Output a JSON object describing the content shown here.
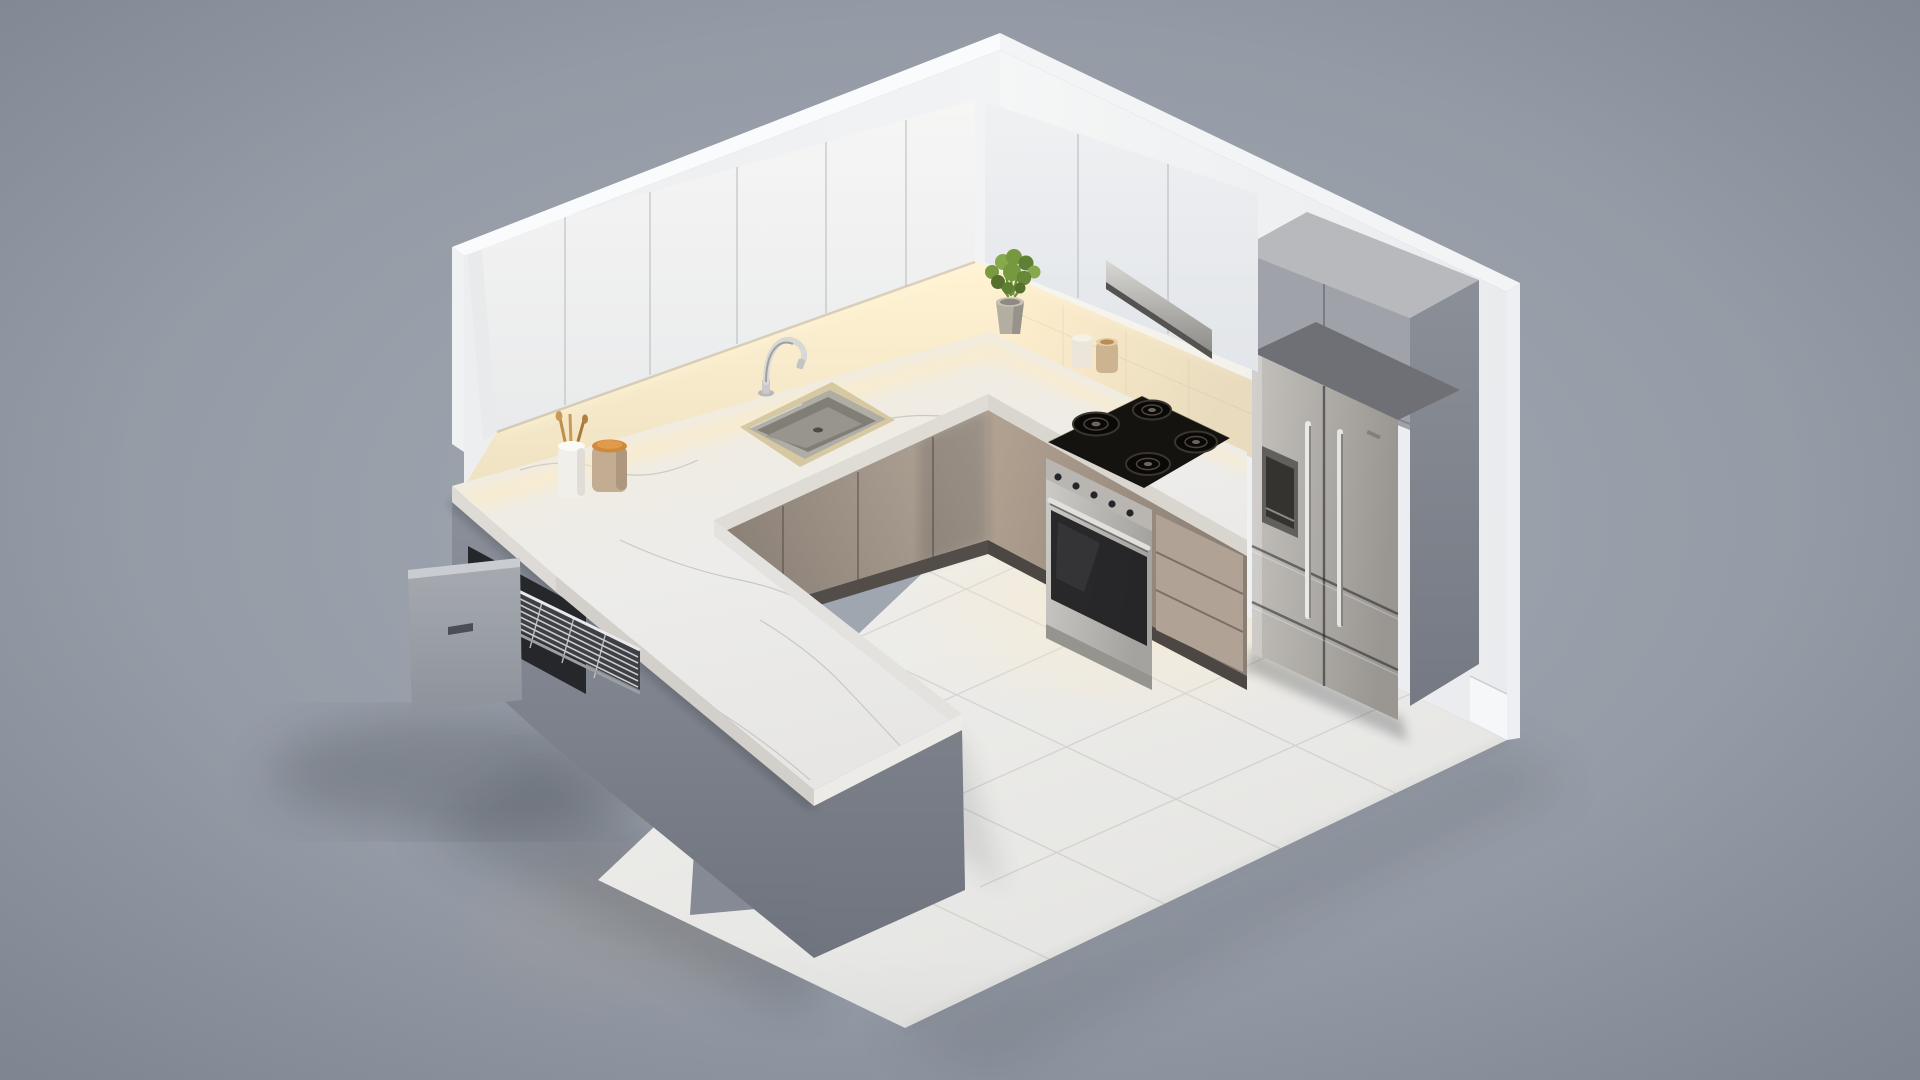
{
  "scene": {
    "description": "Isometric 3D render of a modern cutaway kitchen with white upper cabinets, warm under-cabinet LED lighting, white marble U-shaped countertop with front peninsula, gas cooktop with stainless oven, french-door refrigerator in a gray tall cabinet surround, and an open drawer with a chrome wire basket, all floating on a neutral gray backdrop."
  },
  "colors": {
    "bg_center": "#a3a9b3",
    "bg_edge": "#8b929d",
    "wall": "#f2f3f4",
    "wall_shaded": "#e9ebee",
    "wall_bright": "#fafbfc",
    "cabinet_white": "#f6f6f5",
    "cabinet_white_shade": "#e9eaeb",
    "cabinet_white_right": "#eff1f3",
    "backsplash_glow": "#fff3d3",
    "backsplash_warm": "#efe2c2",
    "led": "#fff7e0",
    "floor": "#f1f0ed",
    "floor_shaded": "#e4e4e2",
    "floor_warm": "#ffedc6",
    "marble": "#edecea",
    "marble_warm": "#f4ecd9",
    "marble_edge": "#dedbd5",
    "cabinet_taupe": "#b6a99b",
    "cabinet_taupe_dark": "#8d8278",
    "island_gray": "#a3a8b0",
    "island_gray_dark": "#6f747e",
    "drawer_panel": "#a7abb1",
    "wire_chrome": "#d4d7d9",
    "steel_light": "#cdcbc7",
    "steel_dark": "#a5a39f",
    "fridge_steel_light": "#c4c1bc",
    "fridge_steel_dark": "#9a9792",
    "tall_cabinet": "#9fa2a9",
    "tall_cabinet_top": "#b7b9bd",
    "tall_cabinet_side": "#82868e",
    "cooktop_black": "#15130f",
    "oven_glass": "#1b1b1e",
    "sink_rim": "#d6c9a2",
    "sink_steel": "#b0ada5",
    "canister_body": "#c3ad92",
    "canister_lid": "#d0883c",
    "utensil_cup": "#f1efe9",
    "utensil_gold": "#bd8f4a",
    "jar_white": "#ece6da",
    "jar_taupe": "#cdb491",
    "pot": "#b3ada2",
    "foliage": "#7a9a42",
    "foliage_dark": "#55702c",
    "shadow": "#1c2026"
  },
  "objects": [
    {
      "label": "left wall",
      "color": "#f2f3f4"
    },
    {
      "label": "right wall",
      "color": "#e9ebee"
    },
    {
      "label": "upper cabinets left run",
      "color": "#f6f6f5"
    },
    {
      "label": "upper cabinets right run",
      "color": "#eff1f3"
    },
    {
      "label": "under-cabinet LED light",
      "color": "#fff7e0"
    },
    {
      "label": "range hood strip",
      "color": "#b9b7b3"
    },
    {
      "label": "backsplash",
      "color": "#efe2c2"
    },
    {
      "label": "marble countertop with peninsula",
      "color": "#edecea"
    },
    {
      "label": "kitchen sink",
      "color": "#b0ada5"
    },
    {
      "label": "chrome faucet",
      "color": "#d8d8d6"
    },
    {
      "label": "gas cooktop",
      "color": "#15130f"
    },
    {
      "label": "stainless oven",
      "color": "#cdcbc7"
    },
    {
      "label": "drawer stack",
      "color": "#b0a295"
    },
    {
      "label": "french-door refrigerator",
      "color": "#c4c1bc"
    },
    {
      "label": "fridge tall cabinet surround",
      "color": "#9fa2a9"
    },
    {
      "label": "base cabinets",
      "color": "#b6a99b"
    },
    {
      "label": "peninsula island",
      "color": "#a3a8b0"
    },
    {
      "label": "open drawer with wire basket",
      "color": "#d4d7d9"
    },
    {
      "label": "tiled floor",
      "color": "#f1f0ed"
    },
    {
      "label": "potted plant",
      "color": "#7a9a42"
    },
    {
      "label": "canister with wood lid",
      "color": "#d0883c"
    },
    {
      "label": "utensil holder",
      "color": "#f1efe9"
    },
    {
      "label": "spice jars",
      "color": "#cdb491"
    }
  ]
}
